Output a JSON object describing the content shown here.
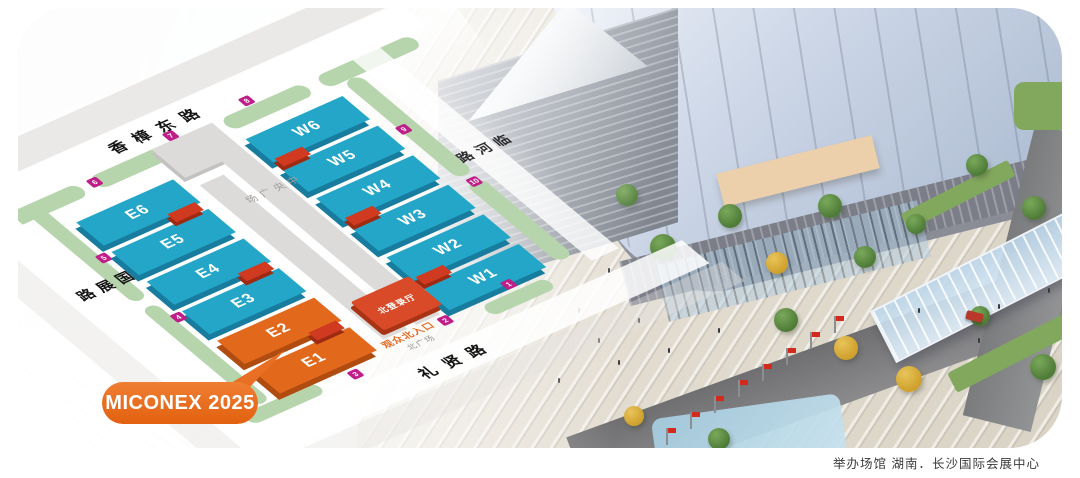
{
  "caption": "举办场馆 湖南．长沙国际会展中心",
  "event_label": "MICONEX 2025",
  "map": {
    "roads": {
      "top": "香樟东路",
      "left": "国展路",
      "bottom": "礼贤路",
      "right": "临河路"
    },
    "corridor_label": "中央广场",
    "halls_east": [
      "E6",
      "E5",
      "E4",
      "E3",
      "E2",
      "E1"
    ],
    "halls_west": [
      "W6",
      "W5",
      "W4",
      "W3",
      "W2",
      "W1"
    ],
    "registration_hall": "北登录厅",
    "entrance_label": "观众北入口",
    "plaza_label": "北广场",
    "markers": [
      "1",
      "2",
      "3",
      "4",
      "5",
      "6",
      "7",
      "8",
      "9",
      "10"
    ],
    "colors": {
      "hall_blue": "#23a6c7",
      "hall_orange": "#e2681c",
      "connector_red": "#d03a20",
      "marker_magenta": "#bf1d88",
      "bubble_orange": "#e96f24",
      "green_strip": "#b7d5ad"
    }
  }
}
